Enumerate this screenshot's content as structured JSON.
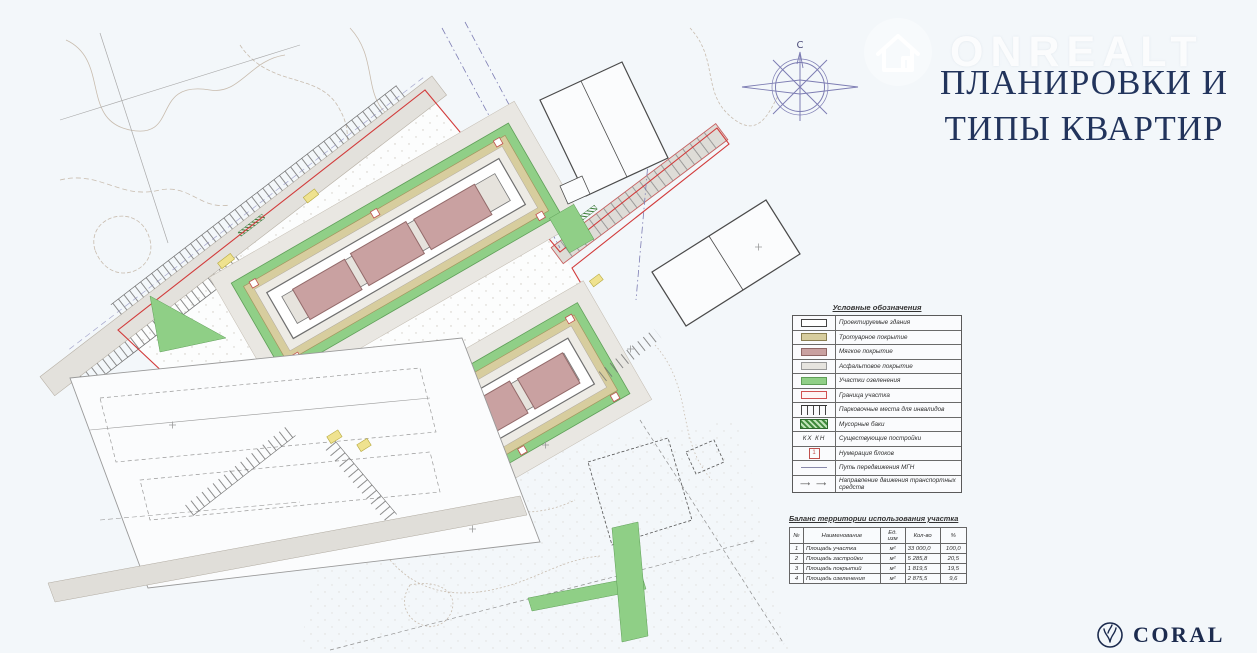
{
  "page": {
    "background": "#f3f7fa"
  },
  "watermark": {
    "brand": "ONREALT",
    "icon": "house-icon"
  },
  "title": {
    "line1": "ПЛАНИРОВКИ И",
    "line2": "ТИПЫ КВАРТИР",
    "color": "#22345c"
  },
  "compass": {
    "north_label": "С"
  },
  "plan": {
    "colors": {
      "green_area": "#8fcf86",
      "sidewalk_tan": "#d7cd9e",
      "soft_cover_mauve": "#c9a1a1",
      "asphalt_gray": "#e6e4df",
      "boundary_red": "#d23b3b",
      "utility_blue": "#7d7db3",
      "contour_brown": "#c8bcae",
      "island_yellow": "#efe28f"
    }
  },
  "legend": {
    "title": "Условные обозначения",
    "items": [
      {
        "label": "Проектируемые здания"
      },
      {
        "label": "Тротуарное покрытие"
      },
      {
        "label": "Мягкое покрытие"
      },
      {
        "label": "Асфальтовое покрытие"
      },
      {
        "label": "Участки озеленения"
      },
      {
        "label": "Граница участка"
      },
      {
        "label": "Парковочные места для инвалидов"
      },
      {
        "label": "Мусорные баки"
      },
      {
        "label": "Существующие постройки",
        "swatch_text": "КХ   КН"
      },
      {
        "label": "Нумерация блоков",
        "swatch_text": "1"
      },
      {
        "label": "Путь передвижения МГН"
      },
      {
        "label": "Направление движения транспортных средств",
        "swatch_text": "⟶  ⟶"
      }
    ]
  },
  "balance": {
    "title": "Баланс территории использования участка",
    "headers": [
      "№",
      "Наименование",
      "Ед. изм",
      "Кол-во",
      "%"
    ],
    "rows": [
      [
        "1",
        "Площадь участка",
        "м²",
        "33 000,0",
        "100,0"
      ],
      [
        "2",
        "Площадь застройки",
        "м²",
        "5 285,8",
        "20,5"
      ],
      [
        "3",
        "Площадь покрытий",
        "м²",
        "1 819,5",
        "19,5"
      ],
      [
        "4",
        "Площадь озеленения",
        "м²",
        "2 875,5",
        "9,6"
      ]
    ]
  },
  "footer_logo": {
    "brand": "CORAL"
  }
}
